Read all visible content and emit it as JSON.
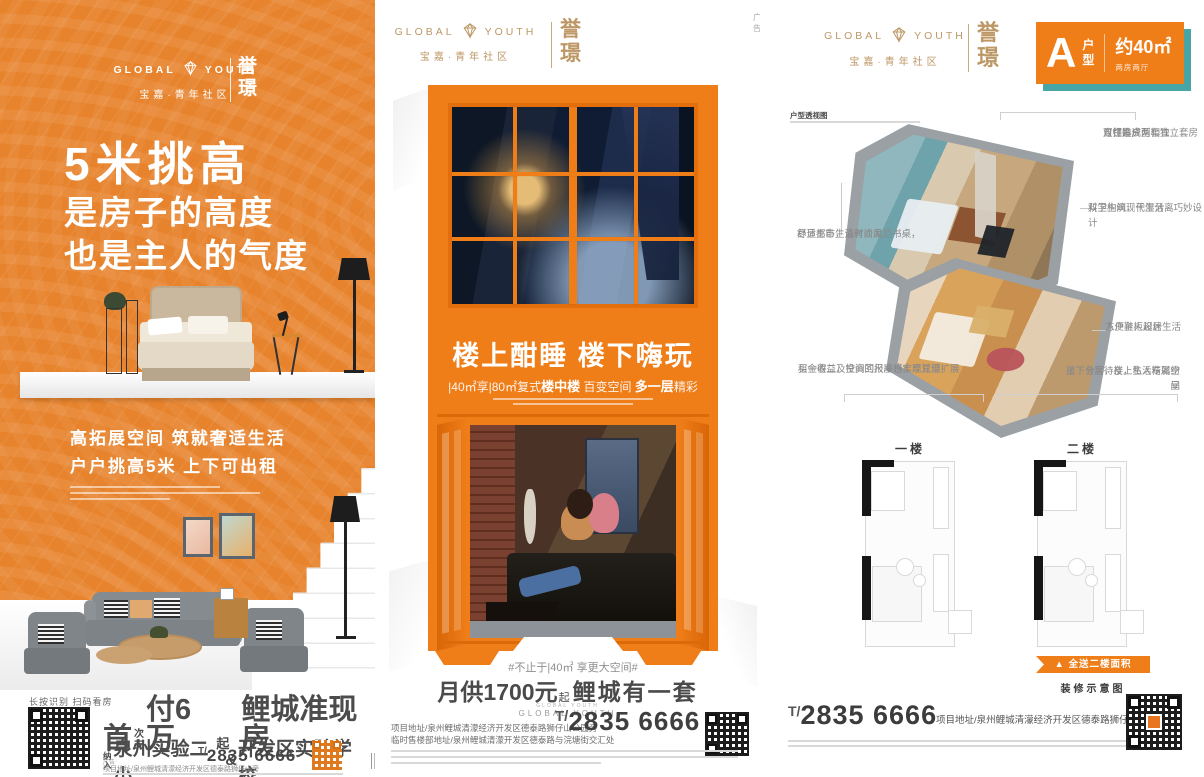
{
  "brand": {
    "name_left": "GLOBAL",
    "name_right": "YOUTH",
    "community": "宝嘉·青年社区",
    "seal_top": "誉",
    "seal_bottom": "璟",
    "small": "GLOBAL YOUTH"
  },
  "left": {
    "headline": "5米挑高",
    "sub1": "是房子的高度",
    "sub2": "也是主人的气度",
    "feat1": "高拓展空间 筑就奢适生活",
    "feat2": "户户挑高5米 上下可出租",
    "qr_caption": "长按识别 扫码看房",
    "price": {
      "p1": "首",
      "st1": "次",
      "st2": "支",
      "p2": "付6万",
      "small": "起",
      "p3": "鲤城准现房"
    },
    "school": {
      "st1": "纳",
      "st2": "入",
      "main": "泉州实验二小",
      "amp": "&",
      "main2": "开发区实验学校"
    },
    "ad_tag": "广告",
    "address": "项目地址/泉州鲤城清濛经济开发区德泰路狮仔山旁",
    "phone_t": "T/",
    "phone_n": "2835 6666"
  },
  "middle": {
    "ad_tag": "广告",
    "headline": "楼上酣睡  楼下嗨玩",
    "subline": {
      "s1": "|40㎡享|80㎡复式",
      "s2": "楼中楼",
      "s3": " 百变空间 ",
      "s4": "多一层",
      "s5": "精彩"
    },
    "hash_line": "#不止于|40㎡ 享更大空间#",
    "monthly": {
      "m1": "月供1700元",
      "small": "起",
      "m2": "鲤城有一套"
    },
    "addr1": "项目地址/泉州鲤城清濛经济开发区德泰路狮仔山公园旁",
    "addr2": "临时售楼部地址/泉州鲤城清濛开发区德泰路与浣塘街交汇处",
    "phone_t": "T/",
    "phone_n": "2835 6666"
  },
  "right": {
    "badge": {
      "letter": "A",
      "hu": "户",
      "xing": "型",
      "area": "约40㎡",
      "rooms": "两房两厅"
    },
    "note_title": "户型透视图",
    "annotations": [
      {
        "lines": [
          "双钥匙户型",
          "可打造成两套独立套房",
          "自住投资两相宜"
        ]
      },
      {
        "lines": [
          "双卫生间，干湿分离巧妙设计",
          "科学构筑现代生活"
        ]
      },
      {
        "lines": [
          "舒适主卧，设有沙发、书桌，",
          "尽显都市生活时尚风范"
        ]
      },
      {
        "lines": [
          "入户鞋柜设计",
          "方便主人起居生活"
        ]
      },
      {
        "lines": [
          "买一得二，空间的尺度感实现双倍扩展",
          "租金收益及投资回报率也丰厚兑现"
        ]
      },
      {
        "lines": [
          "上下分层，楼上私人专属空间",
          "楼下会客待友，生活精彩纷呈"
        ]
      }
    ],
    "floor1": "一楼",
    "floor2": "二楼",
    "ribbon": "▲ 全送二楼面积",
    "caption": "装修示意图",
    "phone_t": "T/",
    "phone_n": "2835 6666",
    "address": "项目地址/泉州鲤城清濛经济开发区德泰路狮仔山公园旁"
  }
}
